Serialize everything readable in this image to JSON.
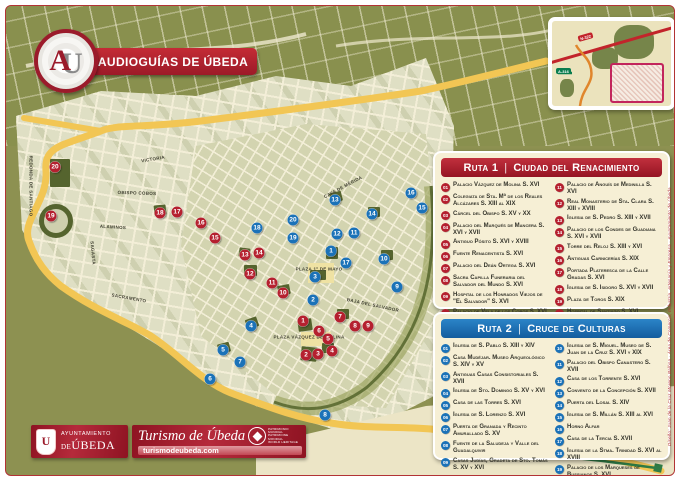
{
  "header": {
    "title": "AUDIOGUÍAS DE ÚBEDA",
    "logo_letters": {
      "a": "A",
      "u": "U"
    }
  },
  "inset": {
    "road1": "N-322",
    "road2": "A-316"
  },
  "ruta1": {
    "title": "Ruta 1",
    "sep": "|",
    "name": "Ciudad del Renacimiento",
    "color": "#b5202f",
    "items": [
      {
        "num": "01",
        "label": "Palacio Vázquez de Molina S. XVI"
      },
      {
        "num": "02",
        "label": "Colegiata de Sta. Mª de los Reales Alcázares S. XIII al XIX"
      },
      {
        "num": "03",
        "label": "Cárcel del Obispo S. XV y XX"
      },
      {
        "num": "04",
        "label": "Palacio del Marqués de Mancera S. XVI y XVII"
      },
      {
        "num": "05",
        "label": "Antiguo Pósito S. XVI y XVIII"
      },
      {
        "num": "06",
        "label": "Fuente Renacentista S. XVI"
      },
      {
        "num": "07",
        "label": "Palacio del Deán Ortega S. XVI"
      },
      {
        "num": "08",
        "label": "Sacra Capilla Funeraria del Salvador del Mundo S. XVI"
      },
      {
        "num": "09",
        "label": "Hospital de los Honrados Viejos de \"El Salvador\" S. XVI"
      },
      {
        "num": "10",
        "label": "Palacio de Vela de los Cobos S. XVI"
      },
      {
        "num": "11",
        "label": "Palacio de Anguís de Medinilla S. XVI"
      },
      {
        "num": "12",
        "label": "Real Monasterio de Sta. Clara S. XIII y XVIII"
      },
      {
        "num": "13",
        "label": "Iglesia de S. Pedro S. XIII y XVII"
      },
      {
        "num": "14",
        "label": "Palacio de los Condes de Guadiana S. XVI y XVII"
      },
      {
        "num": "15",
        "label": "Torre del Reloj S. XIII y XVI"
      },
      {
        "num": "16",
        "label": "Antiguas Carnicerías S. XIX"
      },
      {
        "num": "17",
        "label": "Portada Plateresca de la Calle Gradas S. XVI"
      },
      {
        "num": "18",
        "label": "Iglesia de S. Isidoro S. XVI y XVII"
      },
      {
        "num": "19",
        "label": "Plaza de Toros S. XIX"
      },
      {
        "num": "20",
        "label": "Hospital de Santiago S. XVI"
      }
    ]
  },
  "ruta2": {
    "title": "Ruta 2",
    "sep": "|",
    "name": "Cruce de Culturas",
    "color": "#1b72b8",
    "items": [
      {
        "num": "01",
        "label": "Iglesia de S. Pablo S. XIII y XIV"
      },
      {
        "num": "02",
        "label": "Casa Mudéjar. Museo Arqueológico S. XIV y XV"
      },
      {
        "num": "03",
        "label": "Antiguas Casas Consistoriales S. XVII"
      },
      {
        "num": "04",
        "label": "Iglesia de Sto. Domingo S. XV y XVI"
      },
      {
        "num": "05",
        "label": "Casa de las Torres S. XVI"
      },
      {
        "num": "06",
        "label": "Iglesia de S. Lorenzo S. XVI"
      },
      {
        "num": "07",
        "label": "Puerta de Granada y Recinto Amurallado S. XV"
      },
      {
        "num": "08",
        "label": "Fuente de la Saludeja y Valle del Guadalquivir"
      },
      {
        "num": "09",
        "label": "Casas Judías, Gradeta de Sto. Tomás S. XV y XVI"
      },
      {
        "num": "10",
        "label": "Iglesia de S. Miguel. Museo de S. Juan de la Cruz S. XVI y XIX"
      },
      {
        "num": "11",
        "label": "Palacio del Obispo Canastero S. XVII"
      },
      {
        "num": "12",
        "label": "Casa de los Torrente S. XVI"
      },
      {
        "num": "13",
        "label": "Convento de la Concepción S. XVII"
      },
      {
        "num": "14",
        "label": "Puerta del Losal S. XIV"
      },
      {
        "num": "15",
        "label": "Iglesia de S. Millán S. XIII al XVI"
      },
      {
        "num": "16",
        "label": "Horno Alfar"
      },
      {
        "num": "17",
        "label": "Casa de la Tercia S. XVII"
      },
      {
        "num": "18",
        "label": "Iglesia de la Stma. Trinidad S. XVI al XVIII"
      },
      {
        "num": "19",
        "label": "Palacio de los Marqueses de Bussianos S. XVI"
      },
      {
        "num": "20",
        "label": "Iglesia S. Nicolás de Bari S. XIV al XVI"
      }
    ]
  },
  "map": {
    "ruta1_markers": [
      {
        "n": 1,
        "x": 302,
        "y": 320
      },
      {
        "n": 2,
        "x": 305,
        "y": 354
      },
      {
        "n": 3,
        "x": 317,
        "y": 353
      },
      {
        "n": 4,
        "x": 331,
        "y": 350
      },
      {
        "n": 5,
        "x": 327,
        "y": 338
      },
      {
        "n": 6,
        "x": 318,
        "y": 330
      },
      {
        "n": 7,
        "x": 339,
        "y": 316
      },
      {
        "n": 8,
        "x": 354,
        "y": 325
      },
      {
        "n": 9,
        "x": 367,
        "y": 325
      },
      {
        "n": 10,
        "x": 282,
        "y": 292
      },
      {
        "n": 11,
        "x": 271,
        "y": 282
      },
      {
        "n": 12,
        "x": 249,
        "y": 273
      },
      {
        "n": 13,
        "x": 244,
        "y": 254
      },
      {
        "n": 14,
        "x": 258,
        "y": 252
      },
      {
        "n": 15,
        "x": 214,
        "y": 237
      },
      {
        "n": 16,
        "x": 200,
        "y": 222
      },
      {
        "n": 17,
        "x": 176,
        "y": 211
      },
      {
        "n": 18,
        "x": 159,
        "y": 212
      },
      {
        "n": 19,
        "x": 50,
        "y": 215
      },
      {
        "n": 20,
        "x": 54,
        "y": 166
      }
    ],
    "ruta2_markers": [
      {
        "n": 1,
        "x": 330,
        "y": 250
      },
      {
        "n": 2,
        "x": 312,
        "y": 299
      },
      {
        "n": 3,
        "x": 314,
        "y": 276
      },
      {
        "n": 4,
        "x": 250,
        "y": 325
      },
      {
        "n": 5,
        "x": 222,
        "y": 349
      },
      {
        "n": 6,
        "x": 209,
        "y": 378
      },
      {
        "n": 7,
        "x": 239,
        "y": 361
      },
      {
        "n": 8,
        "x": 324,
        "y": 414
      },
      {
        "n": 9,
        "x": 396,
        "y": 286
      },
      {
        "n": 10,
        "x": 383,
        "y": 258
      },
      {
        "n": 11,
        "x": 353,
        "y": 232
      },
      {
        "n": 12,
        "x": 336,
        "y": 233
      },
      {
        "n": 13,
        "x": 334,
        "y": 199
      },
      {
        "n": 14,
        "x": 371,
        "y": 213
      },
      {
        "n": 15,
        "x": 421,
        "y": 207
      },
      {
        "n": 16,
        "x": 410,
        "y": 192
      },
      {
        "n": 17,
        "x": 345,
        "y": 262
      },
      {
        "n": 18,
        "x": 256,
        "y": 227
      },
      {
        "n": 19,
        "x": 292,
        "y": 237
      },
      {
        "n": 20,
        "x": 292,
        "y": 219
      }
    ],
    "labels": [
      {
        "t": "Victoria",
        "x": 152,
        "y": 158,
        "r": -9
      },
      {
        "t": "Obispo Cobos",
        "x": 136,
        "y": 192,
        "r": 2
      },
      {
        "t": "Alaminos",
        "x": 112,
        "y": 226,
        "r": 3
      },
      {
        "t": "Sagasta",
        "x": 92,
        "y": 252,
        "r": 85
      },
      {
        "t": "Sacramento",
        "x": 128,
        "y": 297,
        "r": 10
      },
      {
        "t": "Redonda de Santiago",
        "x": 30,
        "y": 185,
        "r": 90
      },
      {
        "t": "Plaza 1º de Mayo",
        "x": 318,
        "y": 268,
        "r": 0
      },
      {
        "t": "Plaza Vázquez de Molina",
        "x": 308,
        "y": 336,
        "r": 0
      },
      {
        "t": "Baja del Salvador",
        "x": 372,
        "y": 304,
        "r": 12
      },
      {
        "t": "Cava de Mérida",
        "x": 342,
        "y": 186,
        "r": -28
      }
    ]
  },
  "footer": {
    "ayto_line1": "Ayuntamiento",
    "ayto_de": "de",
    "ayto_city": "Úbeda",
    "turismo": "Turismo de Úbeda",
    "web": "turismodeubeda.com",
    "unesco_lines": [
      "Patrimonio Mundial",
      "Patrimoine Mondial",
      "World Heritage"
    ]
  },
  "credit": "Diseño: Juan de la Cruz Moreno Balboa · Área de Comercio, Industria, Artesanía y Empresa · Ayuntamiento de Úbeda"
}
